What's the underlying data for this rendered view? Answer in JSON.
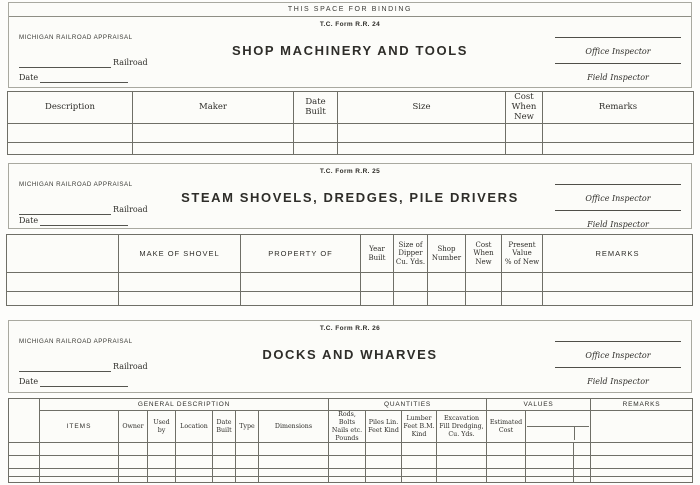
{
  "binding_label": "THIS SPACE FOR BINDING",
  "colors": {
    "paper": "#fcfcf9",
    "ink": "#2e2d29",
    "rule_dark": "#6f6f67",
    "rule_light": "#a9a9a0"
  },
  "forms": [
    {
      "form_no": "T.C. Form R.R. 24",
      "agency": "MICHIGAN RAILROAD APPRAISAL",
      "railroad_label": "Railroad",
      "date_label": "Date",
      "title": "SHOP MACHINERY AND TOOLS",
      "office_inspector": "Office Inspector",
      "field_inspector": "Field Inspector"
    },
    {
      "form_no": "T.C. Form R.R. 25",
      "agency": "MICHIGAN RAILROAD APPRAISAL",
      "railroad_label": "Railroad",
      "date_label": "Date",
      "title": "STEAM SHOVELS, DREDGES, PILE DRIVERS",
      "office_inspector": "Office Inspector",
      "field_inspector": "Field Inspector"
    },
    {
      "form_no": "T.C. Form R.R. 26",
      "agency": "MICHIGAN RAILROAD APPRAISAL",
      "railroad_label": "Railroad",
      "date_label": "Date",
      "title": "DOCKS AND WHARVES",
      "office_inspector": "Office Inspector",
      "field_inspector": "Field Inspector"
    }
  ],
  "tables": {
    "rr24": {
      "columns": [
        "Description",
        "Maker",
        "Date\nBuilt",
        "Size",
        "Cost\nWhen\nNew",
        "Remarks"
      ]
    },
    "rr25": {
      "columns": [
        "",
        "MAKE OF SHOVEL",
        "PROPERTY OF",
        "Year\nBuilt",
        "Size of\nDipper\nCu. Yds.",
        "Shop\nNumber",
        "Cost\nWhen\nNew",
        "Present\nValue\n% of New",
        "REMARKS"
      ]
    },
    "rr26": {
      "group_headers": [
        "GENERAL DESCRIPTION",
        "QUANTITIES",
        "VALUES",
        "REMARKS"
      ],
      "general_columns": [
        "ITEMS",
        "Owner",
        "Used by",
        "Location",
        "Date\nBuilt",
        "Type",
        "Dimensions"
      ],
      "quantities_columns": [
        "Rods, Bolts\nNails etc.\nPounds",
        "Piles Lin.\nFeet Kind",
        "Lumber\nFeet B.M.\nKind",
        "Excavation\nFill Dredging,\nCu. Yds."
      ],
      "values_columns": [
        "Estimated\nCost"
      ]
    }
  }
}
